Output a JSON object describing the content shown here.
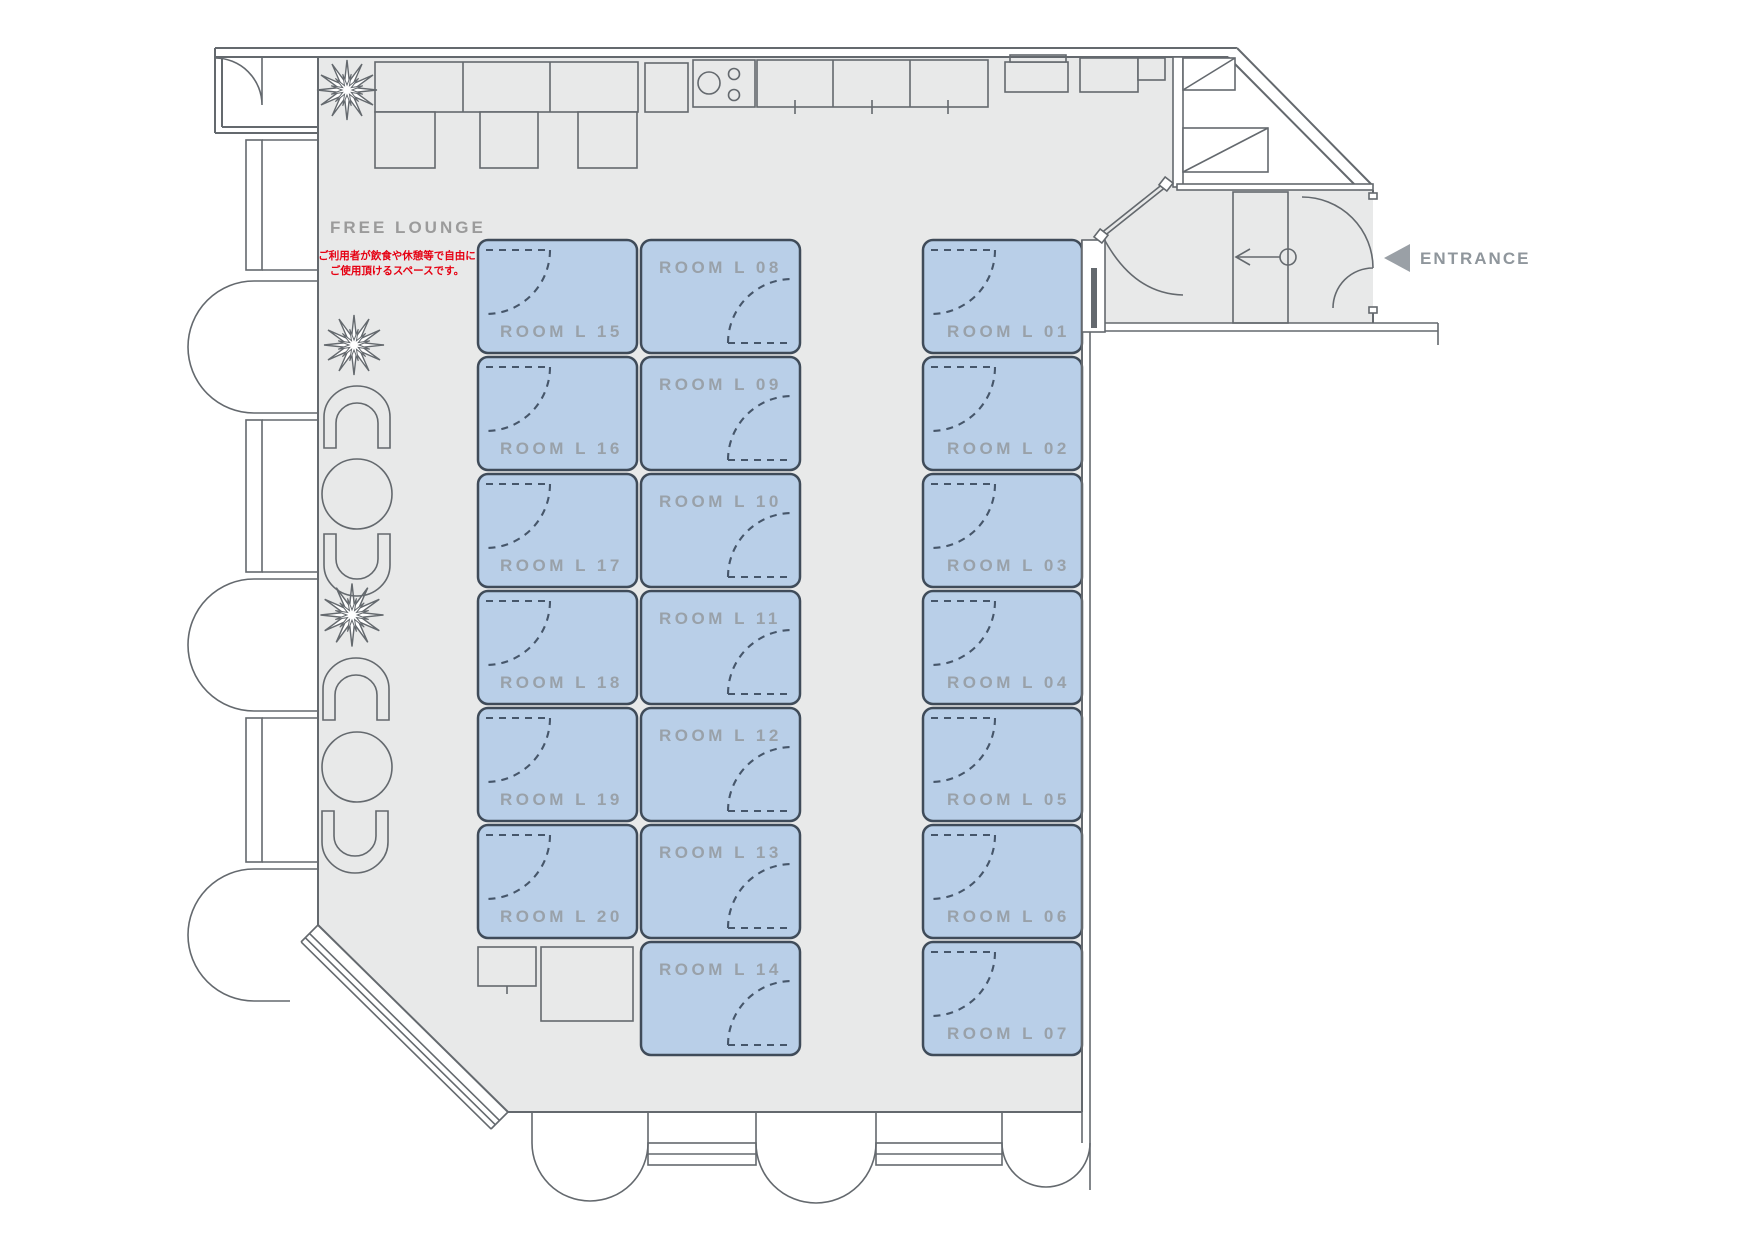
{
  "plan": {
    "lounge": {
      "title": "FREE LOUNGE",
      "note_line1": "ご利用者が飲食や休憩等で自由に",
      "note_line2": "ご使用頂けるスペースです。"
    },
    "entrance": {
      "label": "ENTRANCE"
    }
  },
  "rooms": [
    {
      "id": "L01",
      "label": "ROOM L 01"
    },
    {
      "id": "L02",
      "label": "ROOM L 02"
    },
    {
      "id": "L03",
      "label": "ROOM L 03"
    },
    {
      "id": "L04",
      "label": "ROOM L 04"
    },
    {
      "id": "L05",
      "label": "ROOM L 05"
    },
    {
      "id": "L06",
      "label": "ROOM L 06"
    },
    {
      "id": "L07",
      "label": "ROOM L 07"
    },
    {
      "id": "L08",
      "label": "ROOM L 08"
    },
    {
      "id": "L09",
      "label": "ROOM L 09"
    },
    {
      "id": "L10",
      "label": "ROOM L 10"
    },
    {
      "id": "L11",
      "label": "ROOM L 11"
    },
    {
      "id": "L12",
      "label": "ROOM L 12"
    },
    {
      "id": "L13",
      "label": "ROOM L 13"
    },
    {
      "id": "L14",
      "label": "ROOM L 14"
    },
    {
      "id": "L15",
      "label": "ROOM L 15"
    },
    {
      "id": "L16",
      "label": "ROOM L 16"
    },
    {
      "id": "L17",
      "label": "ROOM L 17"
    },
    {
      "id": "L18",
      "label": "ROOM L 18"
    },
    {
      "id": "L19",
      "label": "ROOM L 19"
    },
    {
      "id": "L20",
      "label": "ROOM L 20"
    }
  ],
  "colors": {
    "floor": "#e8e9e9",
    "wall": "#64696e",
    "room_fill": "#b9cfe8",
    "room_border": "#3f4b59",
    "door_arc": "#46566a",
    "room_label": "#99a1a9",
    "lounge_label": "#9b9b9b",
    "note_red": "#e60012",
    "entrance_label": "#8f969c",
    "entrance_arrow": "#9aa0a6"
  }
}
